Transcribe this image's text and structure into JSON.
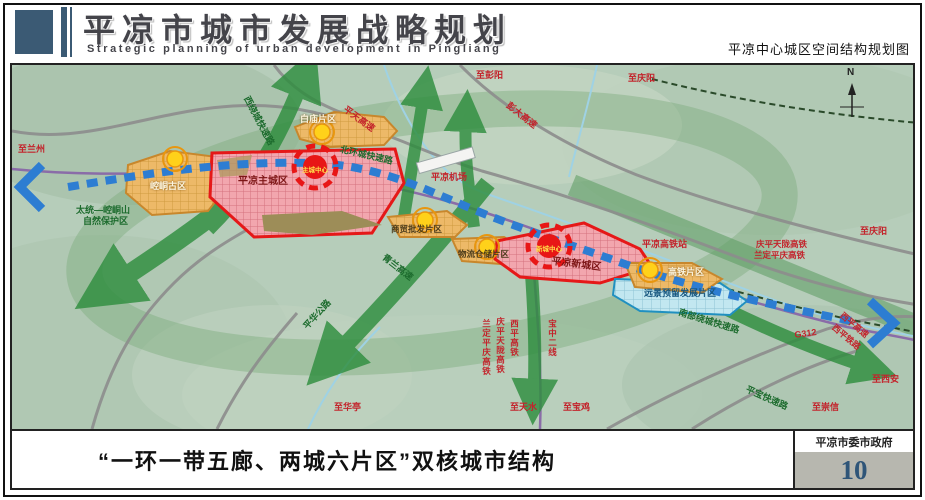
{
  "header": {
    "title": "平凉市城市发展战略规划",
    "subtitle_en": "Strategic planning of urban development in Pingliang",
    "map_subtitle": "平凉中心城区空间结构规划图"
  },
  "caption": {
    "text": "“一环一带五廊、两城六片区”双核城市结构"
  },
  "footer": {
    "org": "平凉市委市政府",
    "page_number": "10"
  },
  "map": {
    "compass_label": "N",
    "labels": {
      "to_lanzhou": "至兰州",
      "west_ring_expwy": "西绕城快速路",
      "baimiao_district": "白庙片区",
      "pingtian_expwy": "平天高速",
      "to_pengyang": "至彭阳",
      "to_qingyang_north": "至庆阳",
      "pengda_expwy": "彭大高速",
      "pingliang_airport": "平凉机场",
      "north_ring_expwy": "北环城快速路",
      "kongtong_old_district": "崆峒古区",
      "main_city": "平凉主城区",
      "main_core": "主城中心",
      "nature_reserve_line1": "太统—崆峒山",
      "nature_reserve_line2": "自然保护区",
      "wholesale_district": "商贸批发片区",
      "qinglan_expwy": "青兰高速",
      "logistics_district": "物流仓储片区",
      "new_city": "平凉新城区",
      "new_core": "新城中心",
      "hsr_station": "平凉高铁站",
      "qingping_hsr_ne": "庆平天陇高铁",
      "landing_hsr_ne": "兰定平庆高铁",
      "to_qingyang_east": "至庆阳",
      "hsr_district": "高铁片区",
      "reserved_district": "远景预留发展片区",
      "south_ring_expwy": "南部绕城快速路",
      "g312": "G312",
      "xiping_expwy": "西平高速",
      "xiping_railway": "西平铁路",
      "to_xian": "至西安",
      "pingbao_expwy": "平宝快速路",
      "to_chongxin": "至崇信",
      "to_huating": "至华亭",
      "pinghua_road": "平华公路",
      "landing_hsr_s": "兰定平庆高铁",
      "qingping_hsr_s": "庆平天陇高铁",
      "xiping_hsr_s": "西平高铁",
      "baozhong_line2": "宝中二线",
      "to_tianshui": "至天水",
      "to_baoji": "至宝鸡"
    },
    "palette": {
      "header_accent": "#3b5a74",
      "terrain_green": "#b6cdba",
      "corridor_green": "#2f8e3f",
      "axis_blue": "#2d7dd2",
      "zone_orange": "#edb968",
      "zone_red_fill": "#f2a6ae",
      "zone_red_border": "#e51818",
      "zone_cyan": "#c2e7f0",
      "node_yellow": "#ffd11a",
      "page_number_color": "#2f5578"
    }
  }
}
